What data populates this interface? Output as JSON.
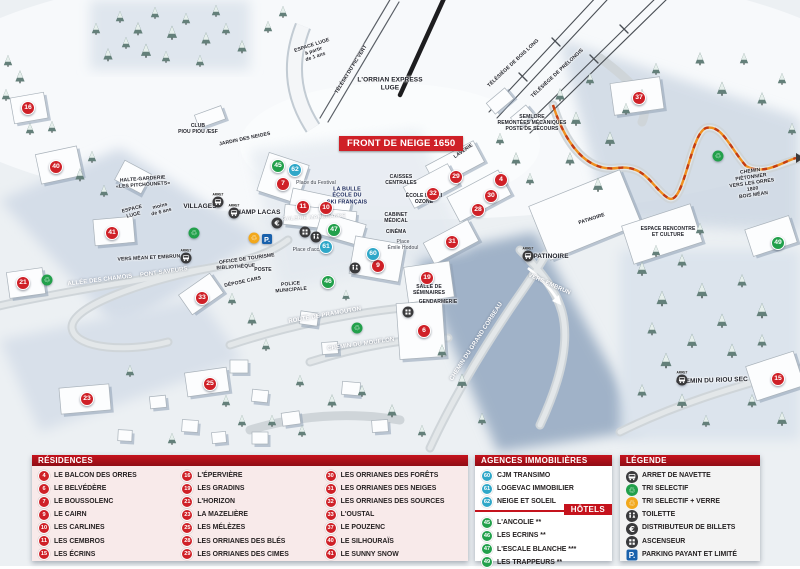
{
  "map": {
    "banner": "FRONT DE NEIGE 1650",
    "stop_prefix": "ARRET",
    "labels": [
      {
        "t": "ESPACE LUGE\nà partir\nde 1 ans",
        "x": 314,
        "y": 52,
        "r": -18,
        "v": "hs"
      },
      {
        "t": "TÉLÉSKI DU PIC VERT",
        "x": 352,
        "y": 70,
        "r": -58,
        "v": "hs"
      },
      {
        "t": "L'ORRIAN EXPRESS\nLUGE",
        "x": 390,
        "y": 84,
        "r": 0,
        "v": "h"
      },
      {
        "t": "TÉLÉSIÈGE DE BOIS LONG",
        "x": 514,
        "y": 64,
        "r": -43,
        "v": "hs"
      },
      {
        "t": "TÉLÉSIÈGE DE PRÉLONGIS",
        "x": 558,
        "y": 74,
        "r": -43,
        "v": "hs"
      },
      {
        "t": "SEMLORE\nREMONTÉES MÉCANIQUES\nPOSTE DE SECOURS",
        "x": 532,
        "y": 124,
        "r": 0,
        "v": "hs"
      },
      {
        "t": "CLUB\nPIOU PIOU /ESF",
        "x": 198,
        "y": 130,
        "r": 0,
        "v": "hs"
      },
      {
        "t": "JARDIN DES NEIGES",
        "x": 245,
        "y": 140,
        "r": -12,
        "v": "hs"
      },
      {
        "t": "HALTE-GARDERIE\n«LES PITCHOUNETS»",
        "x": 143,
        "y": 183,
        "r": -4,
        "v": "hs"
      },
      {
        "t": "ESPACE\nLUGE",
        "x": 133,
        "y": 213,
        "r": -14,
        "v": "hs"
      },
      {
        "t": "moins\nde 6 ans",
        "x": 161,
        "y": 210,
        "r": -14,
        "v": "hs"
      },
      {
        "t": "VILLAGES",
        "x": 200,
        "y": 207,
        "r": 0,
        "v": "h"
      },
      {
        "t": "CHAMP LACAS",
        "x": 256,
        "y": 213,
        "r": 0,
        "v": "h"
      },
      {
        "t": "LA BULLE\nÉCOLE DU\nSKI FRANÇAIS",
        "x": 347,
        "y": 196,
        "r": 0,
        "v": "nav"
      },
      {
        "t": "Place du Festival",
        "x": 316,
        "y": 184,
        "r": 0,
        "v": "pl"
      },
      {
        "t": "CAISSES\nCENTRALES",
        "x": 401,
        "y": 181,
        "r": 0,
        "v": "hs"
      },
      {
        "t": "LAVERIE",
        "x": 464,
        "y": 152,
        "r": -35,
        "v": "hs"
      },
      {
        "t": "GALERIE MARCHANDE",
        "x": 314,
        "y": 218,
        "r": -3,
        "v": "wb"
      },
      {
        "t": "ÉCOLE DE SKI\nOZONE",
        "x": 424,
        "y": 200,
        "r": 0,
        "v": "hs"
      },
      {
        "t": "CABINET\nMÉDICAL",
        "x": 396,
        "y": 219,
        "r": 0,
        "v": "hs"
      },
      {
        "t": "CINÉMA",
        "x": 396,
        "y": 233,
        "r": 0,
        "v": "hs"
      },
      {
        "t": "Place\nÉmile Hodoul",
        "x": 403,
        "y": 246,
        "r": 0,
        "v": "pl"
      },
      {
        "t": "Place d'accueil",
        "x": 310,
        "y": 251,
        "r": 0,
        "v": "pl"
      },
      {
        "t": "OFFICE DE TOURISME",
        "x": 247,
        "y": 260,
        "r": -8,
        "v": "hs"
      },
      {
        "t": "BIBLIOTHÈQUE",
        "x": 236,
        "y": 268,
        "r": -4,
        "v": "hs"
      },
      {
        "t": "POSTE",
        "x": 263,
        "y": 271,
        "r": 0,
        "v": "hs"
      },
      {
        "t": "DÉPOSE CARS",
        "x": 243,
        "y": 283,
        "r": -12,
        "v": "hs"
      },
      {
        "t": "POLICE\nMUNICIPALE",
        "x": 291,
        "y": 288,
        "r": -5,
        "v": "hs"
      },
      {
        "t": "SALLE DE\nSÉMINAIRES",
        "x": 429,
        "y": 291,
        "r": 0,
        "v": "hs"
      },
      {
        "t": "GENDARMERIE",
        "x": 438,
        "y": 303,
        "r": 0,
        "v": "hs"
      },
      {
        "t": "PATINOIRE",
        "x": 592,
        "y": 220,
        "r": -18,
        "v": "hs"
      },
      {
        "t": "PATINOIRE",
        "x": 551,
        "y": 257,
        "r": 0,
        "v": "h"
      },
      {
        "t": "VERS EMBRUN",
        "x": 549,
        "y": 285,
        "r": 24,
        "v": "w"
      },
      {
        "t": "VERS MÉAN ET EMBRUN",
        "x": 149,
        "y": 259,
        "r": -3,
        "v": "hs"
      },
      {
        "t": "PONT SAVEURS",
        "x": 164,
        "y": 273,
        "r": -8,
        "v": "w"
      },
      {
        "t": "ALLÉE DES CHAMOIS",
        "x": 100,
        "y": 281,
        "r": -7,
        "v": "w"
      },
      {
        "t": "ROUTE DE PRAMOUTON",
        "x": 325,
        "y": 316,
        "r": -10,
        "v": "w"
      },
      {
        "t": "CHEMIN DU MOUFLON",
        "x": 361,
        "y": 345,
        "r": -8,
        "v": "w"
      },
      {
        "t": "CHEMIN DU GRAND CORBEAU",
        "x": 477,
        "y": 342,
        "r": -57,
        "v": "w"
      },
      {
        "t": "ESPACE RENCONTRE\nET CULTURE",
        "x": 668,
        "y": 233,
        "r": 0,
        "v": "hs"
      },
      {
        "t": "CHEMIN PIÉTONNIER\nVERS LES ORRES 1800\nBOIS MÉAN",
        "x": 752,
        "y": 184,
        "r": -8,
        "v": "hs"
      },
      {
        "t": "CHEMIN DU RIOU SEC",
        "x": 712,
        "y": 381,
        "r": -2,
        "v": "h"
      }
    ],
    "markers": [
      {
        "n": "16",
        "x": 28,
        "y": 108,
        "c": "red"
      },
      {
        "n": "40",
        "x": 56,
        "y": 167,
        "c": "red"
      },
      {
        "n": "41",
        "x": 112,
        "y": 233,
        "c": "red"
      },
      {
        "n": "21",
        "x": 23,
        "y": 283,
        "c": "red"
      },
      {
        "n": "33",
        "x": 202,
        "y": 298,
        "c": "red"
      },
      {
        "n": "23",
        "x": 87,
        "y": 399,
        "c": "red"
      },
      {
        "n": "25",
        "x": 210,
        "y": 384,
        "c": "red"
      },
      {
        "n": "7",
        "x": 283,
        "y": 184,
        "c": "red"
      },
      {
        "n": "11",
        "x": 303,
        "y": 207,
        "c": "red"
      },
      {
        "n": "10",
        "x": 326,
        "y": 208,
        "c": "red"
      },
      {
        "n": "9",
        "x": 378,
        "y": 266,
        "c": "red"
      },
      {
        "n": "29",
        "x": 456,
        "y": 177,
        "c": "red"
      },
      {
        "n": "32",
        "x": 433,
        "y": 194,
        "c": "red"
      },
      {
        "n": "4",
        "x": 501,
        "y": 180,
        "c": "red"
      },
      {
        "n": "30",
        "x": 491,
        "y": 196,
        "c": "red"
      },
      {
        "n": "28",
        "x": 478,
        "y": 210,
        "c": "red"
      },
      {
        "n": "31",
        "x": 452,
        "y": 242,
        "c": "red"
      },
      {
        "n": "19",
        "x": 427,
        "y": 278,
        "c": "red"
      },
      {
        "n": "6",
        "x": 424,
        "y": 331,
        "c": "red"
      },
      {
        "n": "37",
        "x": 639,
        "y": 98,
        "c": "red"
      },
      {
        "n": "15",
        "x": 778,
        "y": 379,
        "c": "red"
      },
      {
        "n": "62",
        "x": 295,
        "y": 170,
        "c": "blue"
      },
      {
        "n": "61",
        "x": 326,
        "y": 247,
        "c": "blue"
      },
      {
        "n": "60",
        "x": 373,
        "y": 254,
        "c": "blue"
      },
      {
        "n": "45",
        "x": 278,
        "y": 166,
        "c": "green"
      },
      {
        "n": "47",
        "x": 334,
        "y": 230,
        "c": "green"
      },
      {
        "n": "46",
        "x": 328,
        "y": 282,
        "c": "green"
      },
      {
        "n": "49",
        "x": 778,
        "y": 243,
        "c": "green"
      }
    ],
    "icons": [
      {
        "k": "bus",
        "x": 218,
        "y": 202
      },
      {
        "k": "bus",
        "x": 234,
        "y": 213
      },
      {
        "k": "bus",
        "x": 186,
        "y": 258
      },
      {
        "k": "bus",
        "x": 528,
        "y": 256
      },
      {
        "k": "bus",
        "x": 682,
        "y": 380
      },
      {
        "k": "recycle-green",
        "x": 194,
        "y": 233
      },
      {
        "k": "recycle-green",
        "x": 47,
        "y": 280
      },
      {
        "k": "recycle-green",
        "x": 357,
        "y": 328
      },
      {
        "k": "recycle-green",
        "x": 718,
        "y": 156
      },
      {
        "k": "recycle-orange",
        "x": 254,
        "y": 238
      },
      {
        "k": "parking",
        "x": 267,
        "y": 239
      },
      {
        "k": "euro",
        "x": 277,
        "y": 223
      },
      {
        "k": "toilet",
        "x": 316,
        "y": 237
      },
      {
        "k": "toilet",
        "x": 355,
        "y": 268
      },
      {
        "k": "elevator",
        "x": 305,
        "y": 232
      },
      {
        "k": "elevator",
        "x": 408,
        "y": 312
      }
    ]
  },
  "legend": {
    "residences": {
      "title": "RÉSIDENCES",
      "items": [
        {
          "n": "4",
          "label": "LE BALCON DES ORRES"
        },
        {
          "n": "6",
          "label": "LE BELVÉDÈRE"
        },
        {
          "n": "7",
          "label": "LE BOUSSOLENC"
        },
        {
          "n": "9",
          "label": "LE CAIRN"
        },
        {
          "n": "10",
          "label": "LES CARLINES"
        },
        {
          "n": "11",
          "label": "LES CEMBROS"
        },
        {
          "n": "15",
          "label": "LES ÉCRINS"
        },
        {
          "n": "16",
          "label": "L'ÉPERVIÈRE"
        },
        {
          "n": "19",
          "label": "LES GRADINS"
        },
        {
          "n": "21",
          "label": "L'HORIZON"
        },
        {
          "n": "23",
          "label": "LA MAZELIÈRE"
        },
        {
          "n": "25",
          "label": "LES MÉLÈZES"
        },
        {
          "n": "28",
          "label": "LES ORRIANES DES BLÉS"
        },
        {
          "n": "29",
          "label": "LES ORRIANES DES CIMES"
        },
        {
          "n": "30",
          "label": "LES ORRIANES DES FORÊTS"
        },
        {
          "n": "31",
          "label": "LES ORRIANES DES NEIGES"
        },
        {
          "n": "32",
          "label": "LES ORRIANES DES SOURCES"
        },
        {
          "n": "33",
          "label": "L'OUSTAL"
        },
        {
          "n": "37",
          "label": "LE POUZENC"
        },
        {
          "n": "40",
          "label": "LE SILHOURAÏS"
        },
        {
          "n": "41",
          "label": "LE SUNNY SNOW"
        }
      ]
    },
    "agences": {
      "title": "AGENCES IMMOBILIÈRES",
      "items": [
        {
          "n": "60",
          "label": "CJM TRANSIMO"
        },
        {
          "n": "61",
          "label": "LOGEVAC IMMOBILIER"
        },
        {
          "n": "62",
          "label": "NEIGE ET SOLEIL"
        }
      ]
    },
    "hotels": {
      "title": "HÔTELS",
      "items": [
        {
          "n": "45",
          "label": "L'ANCOLIE **"
        },
        {
          "n": "46",
          "label": "LES ECRINS **"
        },
        {
          "n": "47",
          "label": "L'ESCALE BLANCHE ***"
        },
        {
          "n": "49",
          "label": "LES TRAPPEURS **"
        }
      ]
    },
    "legende": {
      "title": "LÉGENDE",
      "items": [
        {
          "icon": "bus",
          "label": "ARRET DE NAVETTE"
        },
        {
          "icon": "recycle-green",
          "label": "TRI SELECTIF"
        },
        {
          "icon": "recycle-orange",
          "label": "TRI SELECTIF + VERRE"
        },
        {
          "icon": "toilet",
          "label": "TOILETTE"
        },
        {
          "icon": "euro",
          "label": "DISTRIBUTEUR DE BILLETS"
        },
        {
          "icon": "elevator",
          "label": "ASCENSEUR"
        },
        {
          "icon": "parking",
          "label": "PARKING PAYANT ET LIMITÉ"
        }
      ]
    }
  },
  "colors": {
    "marker_red": "#cf2027",
    "marker_blue": "#2fa7c8",
    "marker_green": "#22a04b",
    "header_red": "#c5131d",
    "banner_red": "#cf2027",
    "recycle_orange": "#f2a81c",
    "parking_blue": "#1961ac"
  }
}
